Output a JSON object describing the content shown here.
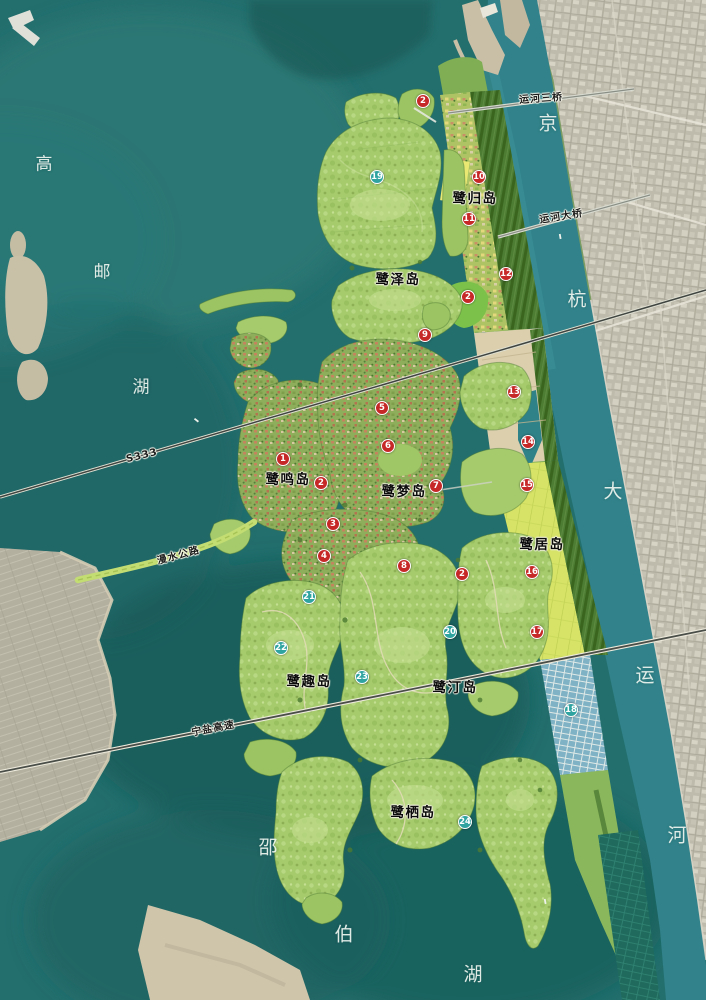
{
  "map": {
    "water_labels": [
      {
        "group": "高邮湖",
        "chars": [
          {
            "c": "高",
            "x": 44,
            "y": 162
          },
          {
            "c": "邮",
            "x": 102,
            "y": 270
          },
          {
            "c": "湖",
            "x": 141,
            "y": 385
          }
        ]
      },
      {
        "group": "邵伯湖",
        "chars": [
          {
            "c": "邵",
            "x": 268,
            "y": 846
          },
          {
            "c": "伯",
            "x": 344,
            "y": 933
          },
          {
            "c": "湖",
            "x": 473,
            "y": 973
          }
        ]
      },
      {
        "group": "京杭大运河",
        "chars": [
          {
            "c": "京",
            "x": 548,
            "y": 122
          },
          {
            "c": "杭",
            "x": 577,
            "y": 298
          },
          {
            "c": "大",
            "x": 613,
            "y": 490
          },
          {
            "c": "运",
            "x": 645,
            "y": 674
          },
          {
            "c": "河",
            "x": 677,
            "y": 834
          }
        ]
      }
    ],
    "island_labels": [
      {
        "text": "鹭归岛",
        "x": 475,
        "y": 197
      },
      {
        "text": "鹭泽岛",
        "x": 398,
        "y": 278
      },
      {
        "text": "鹭鸣岛",
        "x": 288,
        "y": 478
      },
      {
        "text": "鹭梦岛",
        "x": 404,
        "y": 490
      },
      {
        "text": "鹭居岛",
        "x": 542,
        "y": 543
      },
      {
        "text": "鹭趣岛",
        "x": 309,
        "y": 680
      },
      {
        "text": "鹭汀岛",
        "x": 455,
        "y": 686
      },
      {
        "text": "鹭栖岛",
        "x": 413,
        "y": 811
      }
    ],
    "road_labels": [
      {
        "text": "运河三桥",
        "x": 541,
        "y": 97,
        "rot": -4
      },
      {
        "text": "运河大桥",
        "x": 561,
        "y": 215,
        "rot": -9
      },
      {
        "text": "S333",
        "x": 142,
        "y": 456,
        "rot": -14
      },
      {
        "text": "漫水公路",
        "x": 178,
        "y": 554,
        "rot": -15
      },
      {
        "text": "宁盐高速",
        "x": 213,
        "y": 727,
        "rot": -11
      }
    ],
    "markers": [
      {
        "num": "2",
        "x": 423,
        "y": 101,
        "type": "red"
      },
      {
        "num": "19",
        "x": 377,
        "y": 177,
        "type": "teal"
      },
      {
        "num": "10",
        "x": 479,
        "y": 177,
        "type": "red"
      },
      {
        "num": "11",
        "x": 469,
        "y": 219,
        "type": "red"
      },
      {
        "num": "12",
        "x": 506,
        "y": 274,
        "type": "red"
      },
      {
        "num": "2",
        "x": 468,
        "y": 297,
        "type": "red"
      },
      {
        "num": "9",
        "x": 425,
        "y": 335,
        "type": "red"
      },
      {
        "num": "13",
        "x": 514,
        "y": 392,
        "type": "red"
      },
      {
        "num": "5",
        "x": 382,
        "y": 408,
        "type": "red"
      },
      {
        "num": "14",
        "x": 528,
        "y": 442,
        "type": "red"
      },
      {
        "num": "6",
        "x": 388,
        "y": 446,
        "type": "red"
      },
      {
        "num": "1",
        "x": 283,
        "y": 459,
        "type": "red"
      },
      {
        "num": "2",
        "x": 321,
        "y": 483,
        "type": "red"
      },
      {
        "num": "15",
        "x": 527,
        "y": 485,
        "type": "red"
      },
      {
        "num": "7",
        "x": 436,
        "y": 486,
        "type": "red"
      },
      {
        "num": "3",
        "x": 333,
        "y": 524,
        "type": "red"
      },
      {
        "num": "4",
        "x": 324,
        "y": 556,
        "type": "red"
      },
      {
        "num": "8",
        "x": 404,
        "y": 566,
        "type": "red"
      },
      {
        "num": "16",
        "x": 532,
        "y": 572,
        "type": "red"
      },
      {
        "num": "2",
        "x": 462,
        "y": 574,
        "type": "red"
      },
      {
        "num": "21",
        "x": 309,
        "y": 597,
        "type": "teal"
      },
      {
        "num": "17",
        "x": 537,
        "y": 632,
        "type": "red"
      },
      {
        "num": "20",
        "x": 450,
        "y": 632,
        "type": "teal"
      },
      {
        "num": "22",
        "x": 281,
        "y": 648,
        "type": "teal"
      },
      {
        "num": "23",
        "x": 362,
        "y": 677,
        "type": "teal"
      },
      {
        "num": "18",
        "x": 571,
        "y": 710,
        "type": "teal"
      },
      {
        "num": "24",
        "x": 465,
        "y": 822,
        "type": "teal"
      }
    ],
    "colors": {
      "marker_red": "#c62828",
      "marker_teal": "#2fa3a0",
      "lake": "#236f6e",
      "canal": "#31828a",
      "urban": "#bfbbac",
      "island_green": "#a6cb6d",
      "fields_yellow": "#d6e366",
      "sand": "#cfc5ab"
    }
  }
}
